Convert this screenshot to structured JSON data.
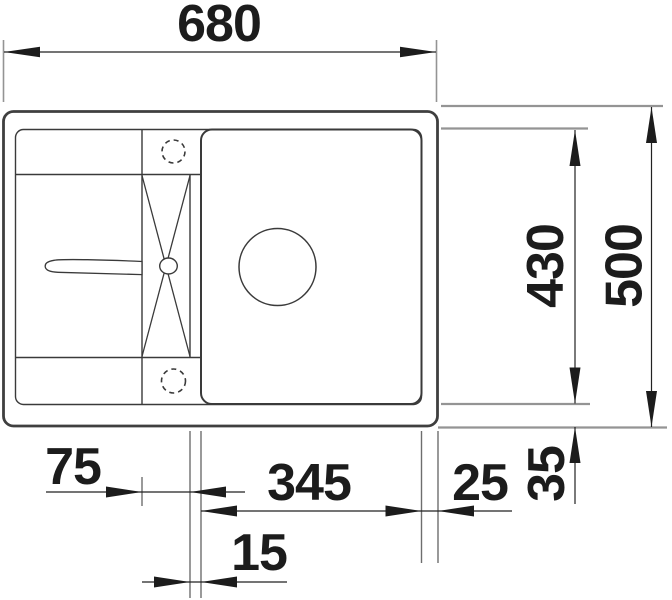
{
  "drawing": {
    "title": "Kitchen sink top-view dimension drawing",
    "unit": "mm",
    "labels": {
      "overall_width": "680",
      "overall_depth": "500",
      "inner_depth": "430",
      "bowl_width": "345",
      "bowl_to_right_edge": "25",
      "bowl_to_bottom_edge": "35",
      "strip_width": "75",
      "strip_to_bowl_gap": "15"
    },
    "colors": {
      "background": "#ffffff",
      "body_line": "#3a3a3a",
      "dimension_line": "#222222",
      "arrow": "#1c1c1c",
      "extension_line": "#949494",
      "text": "#1c1c1c"
    }
  }
}
